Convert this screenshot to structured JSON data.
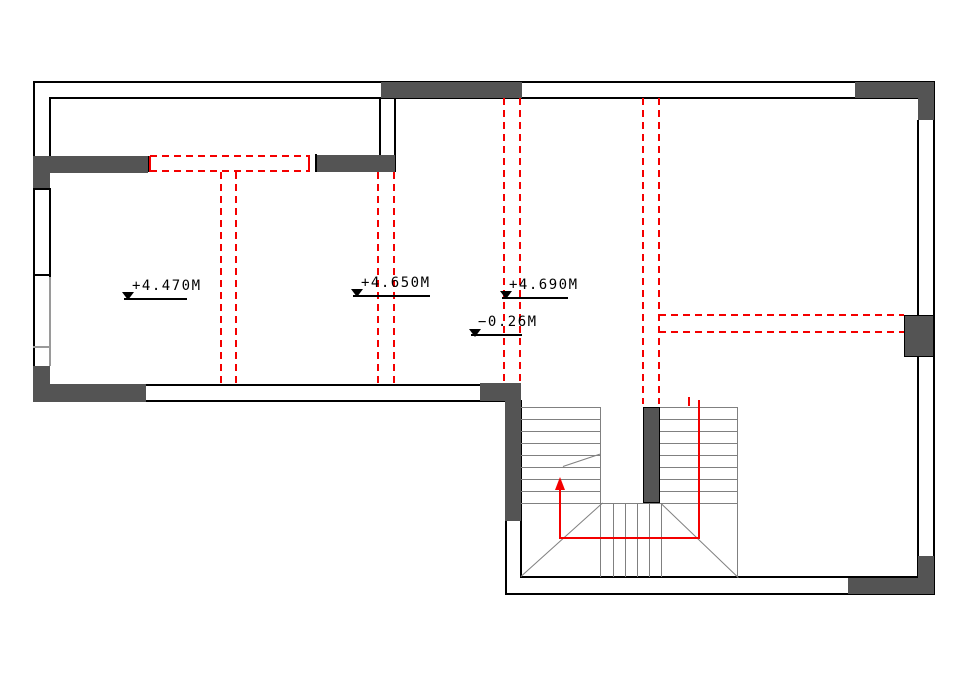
{
  "drawing": {
    "kind": "floor-plan-cad-drawing",
    "markers": [
      {
        "label": "+4.470M"
      },
      {
        "label": "+4.650M"
      },
      {
        "label": "+4.690M"
      },
      {
        "label": "−0.26M"
      }
    ],
    "colors": {
      "wall_fill": "#545454",
      "wall_line": "#000000",
      "stair_line": "#808080",
      "red_accent": "#f40000",
      "background": "#ffffff"
    }
  }
}
